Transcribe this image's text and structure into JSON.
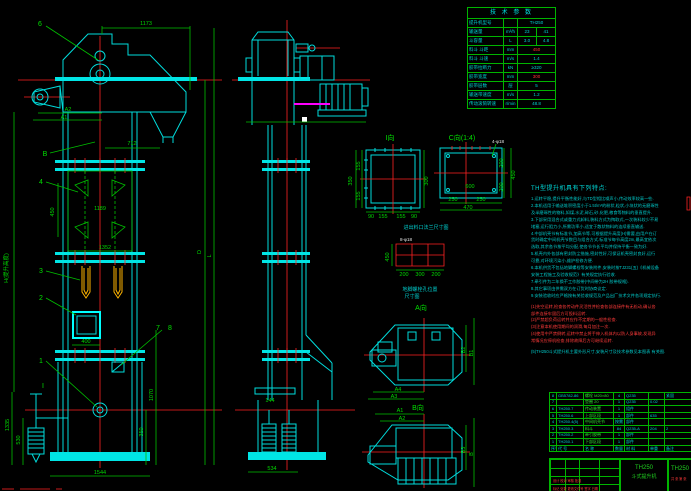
{
  "front": {
    "dims": {
      "top_width": "1173",
      "offset": "712",
      "bucket_pitch": "450",
      "mid_width": "1189",
      "flange_width": "1352",
      "door_width": "400",
      "takeup_height": "1335",
      "weight_height": "530",
      "boot_height": "1070",
      "pulley_height": "350",
      "base_width": "1544",
      "a1": "A1",
      "a2": "A2",
      "d_label": "D",
      "l_label": "L",
      "h_label": "H(提升高度)"
    },
    "callouts": {
      "c1": "1",
      "c2": "2",
      "c3": "3",
      "c4": "4",
      "c6": "6",
      "c7": "7",
      "c8": "8",
      "b": "B",
      "i": "I"
    }
  },
  "side": {
    "dims": {
      "base_width": "534",
      "bracket": "144"
    }
  },
  "details": {
    "view_i": {
      "label": "I向",
      "d350": "350",
      "d155a": "155",
      "d155b": "155",
      "d300": "300",
      "d90a": "90",
      "d155c": "155",
      "d155d": "155",
      "d90b": "90"
    },
    "view_c": {
      "label": "C向(1:4)",
      "note": "4-φ18",
      "d600": "600",
      "d250a": "250",
      "d250b": "250",
      "d470": "470",
      "d200a": "200",
      "d200b": "200",
      "d450": "450"
    },
    "caption_flange": "进出料口法兰尺寸图",
    "bolt_layout": {
      "note": "8-φ18",
      "d450": "450",
      "d200a": "200",
      "d300": "300",
      "d200b": "200",
      "caption1": "地脚螺栓孔位置",
      "caption2": "尺寸图",
      "a_label": "A向"
    },
    "plan": {
      "a4": "A4",
      "a3": "A3",
      "b2": "B2",
      "b1": "B1",
      "a1": "A1",
      "a2": "A2",
      "b3": "B3",
      "b": "B",
      "b_label": "B向"
    }
  },
  "tech_table": {
    "title": "技 术 参 数",
    "rows": [
      {
        "label": "提升机型号",
        "unit": "",
        "v1": "TH250",
        "v2": "",
        "red": false
      },
      {
        "label": "输送量",
        "unit": "m³/h",
        "v1": "23",
        "v2": "41",
        "red": false
      },
      {
        "label": "斗容量",
        "unit": "L",
        "v1": "3.0",
        "v2": "4.8",
        "red": false
      },
      {
        "label": "料斗 斗距",
        "unit": "mm",
        "v1": "450",
        "v2": "",
        "red": true
      },
      {
        "label": "料斗 斗速",
        "unit": "m/s",
        "v1": "1.4",
        "v2": "",
        "red": false
      },
      {
        "label": "胶带拉断力",
        "unit": "kN",
        "v1": "≥320",
        "v2": "",
        "red": false
      },
      {
        "label": "胶带宽度",
        "unit": "mm",
        "v1": "300",
        "v2": "",
        "red": true
      },
      {
        "label": "胶带层数",
        "unit": "层",
        "v1": "5",
        "v2": "",
        "red": false
      },
      {
        "label": "输送带速度",
        "unit": "m/s",
        "v1": "1.2",
        "v2": "",
        "red": false
      },
      {
        "label": "传动滚筒转速",
        "unit": "r/min",
        "v1": "48.8",
        "v2": "",
        "red": false
      }
    ]
  },
  "notes": {
    "title": "TH型提升机具有下列特点:",
    "lines": [
      {
        "t": "1.运转平稳,提升平衡性能好,与TD型相比噪声小,传动效率较高一些.",
        "red": false,
        "gap": false
      },
      {
        "t": "2.本机适用于输送堆积密度小于1.5t/m³的粉状,粒状,小块状的无磨琢性",
        "red": false,
        "gap": false
      },
      {
        "t": "  及半磨琢性的物料,如煤,水泥,碎石,砂,化肥,粮食等物料的垂直提升.",
        "red": false,
        "gap": false
      },
      {
        "t": "3.下部采用混合式或重力式卸料,装料方式为掏取式,一次装料较少不易",
        "red": false,
        "gap": false
      },
      {
        "t": "  堵塞,运行阻力小,所需功率小,适宜于散状物料的连续垂直输送.",
        "red": false,
        "gap": false
      },
      {
        "t": "4.中部机壳节有标准节,加高节等,可根据提升高度(H)需要,由用户在订",
        "red": false,
        "gap": false
      },
      {
        "t": "  货时确定中间机壳节数目与组合方式.标准节每节高度2m,最高宜依次",
        "red": false,
        "gap": false
      },
      {
        "t": "  选取,其余各节按平均分配,使各节节长平均并保持平衡一致为好.",
        "red": false,
        "gap": false
      },
      {
        "t": "5.机壳内外各部有密封防尘措施,密封性好,可保证机壳密封良好,运行",
        "red": false,
        "gap": false
      },
      {
        "t": "  可靠,对环境污染小,维护检修方便.",
        "red": false,
        "gap": false
      },
      {
        "t": "6.本机供货不包括地脚螺栓等安装附件,安装时按TJ231(五)《机械设备",
        "red": false,
        "gap": false
      },
      {
        "t": "  安装工程施工及验收规范》有关规定执行验收.",
        "red": false,
        "gap": false
      },
      {
        "t": "7.牵引件为二年换不工作胶带(中间带为2H 胶带规格).",
        "red": false,
        "gap": false
      },
      {
        "t": "8.其它事项由供需双方在订货时协商议定.",
        "red": false,
        "gap": false
      },
      {
        "t": "9.安装验收时应严格按有关验收规范及产品出厂技术文件各项规定执行.",
        "red": false,
        "gap": false
      },
      {
        "t": "(1)先空运转,检查各传动件灵活性并检查各部连接件有无松动,确认各",
        "red": true,
        "gap": true
      },
      {
        "t": "   部件连接牢固后方可投料运转.",
        "red": true,
        "gap": false
      },
      {
        "t": "(2)严禁超负荷运转并应作不定期的一般性检查.",
        "red": true,
        "gap": false
      },
      {
        "t": "(3)注意本机使用期间的润滑,每月加注一次.",
        "red": true,
        "gap": false
      },
      {
        "t": "(4)使用中严禁倒转,运转中禁止将手伸入机体内以防人身事故,发现异",
        "red": true,
        "gap": false
      },
      {
        "t": "   常情况应停机检查,排除故障后方可继续运转.",
        "red": true,
        "gap": false
      },
      {
        "t": "(5)TH250斗式提升机主要外形尺寸,安装尺寸及技术参数见本图表 有关图.",
        "red": false,
        "gap": true
      }
    ]
  },
  "parts_table": {
    "header": {
      "seq": "序号",
      "code": "代 号",
      "name": "名 称",
      "qty": "数量",
      "mat": "材 料",
      "wt": "单重",
      "note": "备注"
    },
    "rows": [
      {
        "seq": "8",
        "code": "GB5782-86",
        "name": "螺栓 M20×80",
        "qty": "4",
        "mat": "Q235",
        "wt": "",
        "note": "紧固"
      },
      {
        "seq": "7",
        "code": "",
        "name": "垫圈 20",
        "qty": "1",
        "mat": "Q235",
        "wt": "0.02",
        "note": ""
      },
      {
        "seq": "6",
        "code": "TH250.7",
        "name": "传动装置",
        "qty": "1",
        "mat": "组件",
        "wt": "",
        "note": ""
      },
      {
        "seq": "5",
        "code": "TH250.6",
        "name": "上部区段",
        "qty": "1",
        "mat": "部件",
        "wt": "635",
        "note": ""
      },
      {
        "seq": "4",
        "code": "TH250.4(5)",
        "name": "中间机壳节",
        "qty": "按需",
        "mat": "部件",
        "wt": "",
        "note": ""
      },
      {
        "seq": "3",
        "code": "TH250.3",
        "name": "料斗",
        "qty": "84",
        "mat": "Q235-A",
        "wt": "204",
        "note": "2"
      },
      {
        "seq": "2",
        "code": "TH250.2",
        "name": "牵引胶带",
        "qty": "1",
        "mat": "部件",
        "wt": "",
        "note": ""
      },
      {
        "seq": "1",
        "code": "TH250.1",
        "name": "下部区段",
        "qty": "1",
        "mat": "部件",
        "wt": "",
        "note": ""
      }
    ]
  },
  "title_block": {
    "model": "TH250",
    "product": "斗式提升机",
    "drawing_no": "TH250",
    "sig_red1": "标记 处数 更改文件号 签字 日期",
    "sig_red2": "设计 校对 审核 批准",
    "sheet_red": "共 张 第 张"
  }
}
